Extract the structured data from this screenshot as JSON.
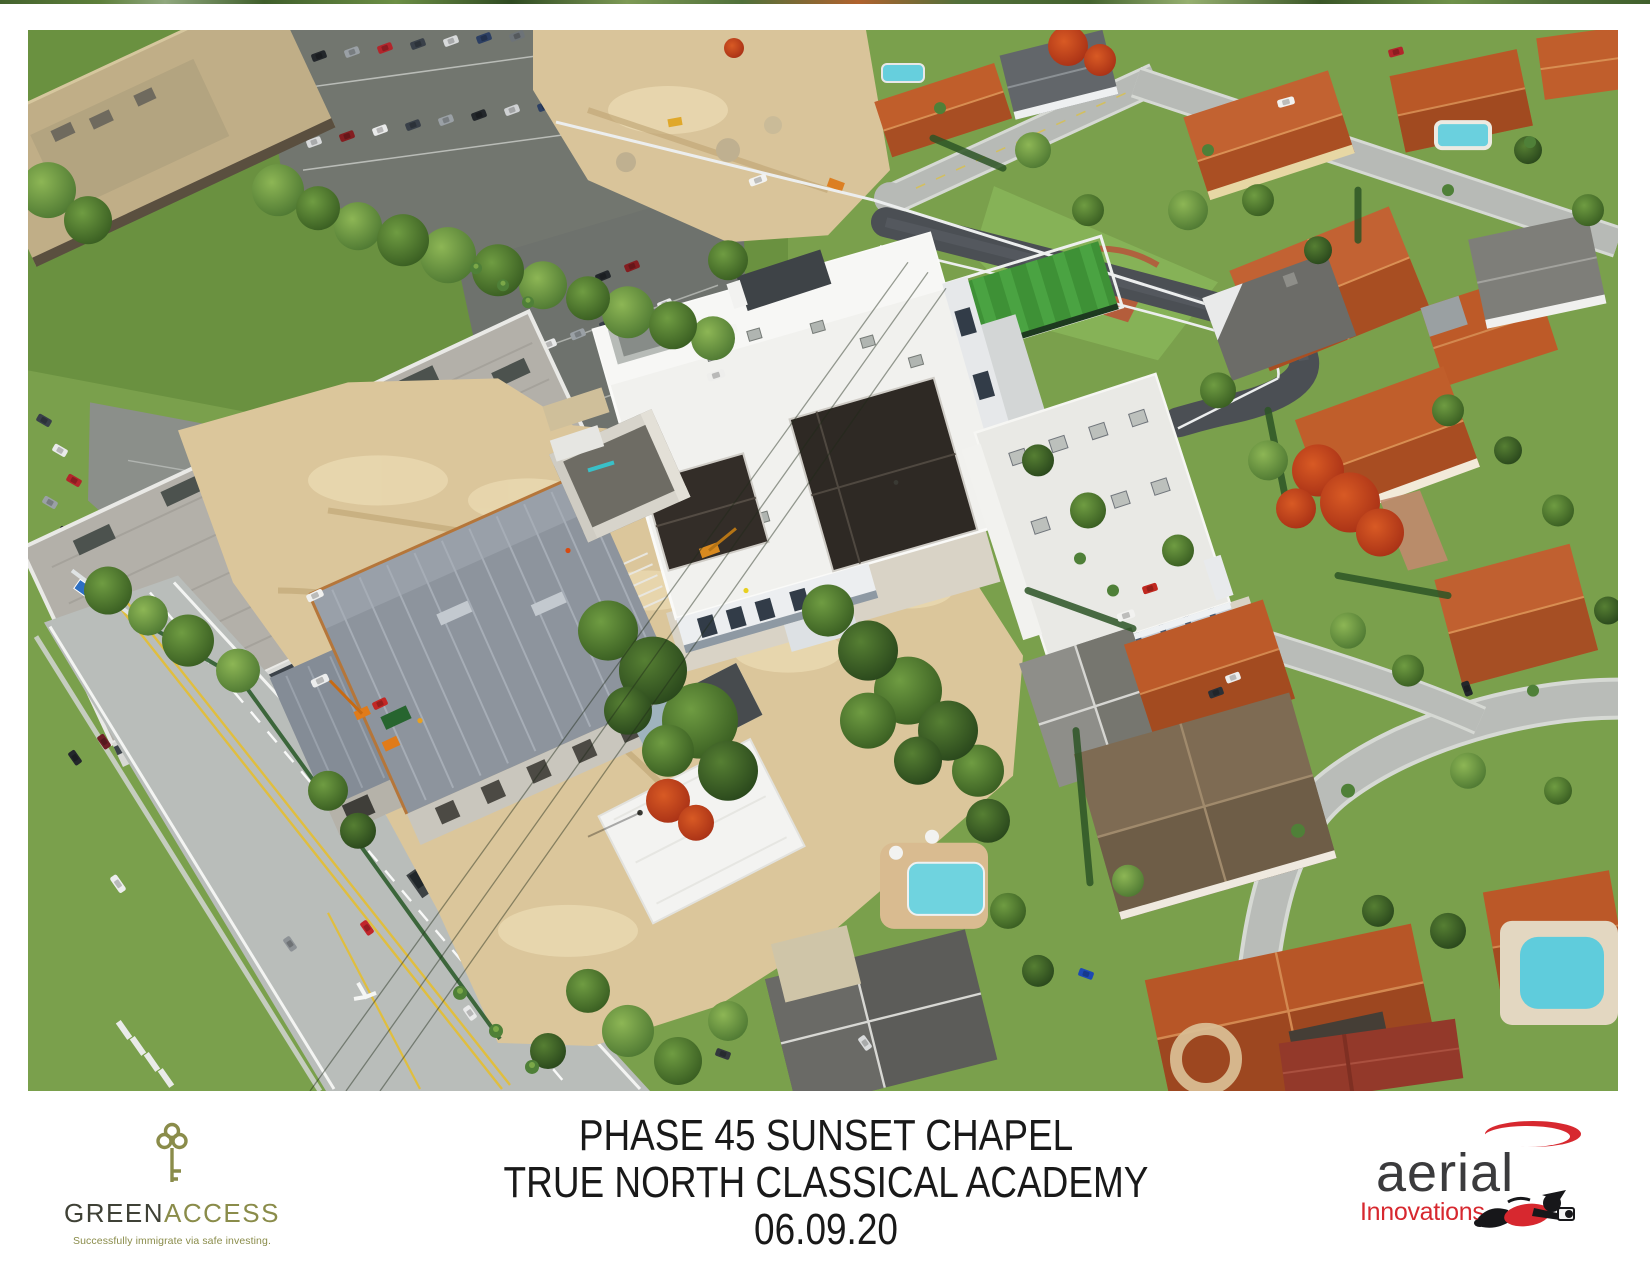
{
  "caption": {
    "line1": "PHASE 45 SUNSET CHAPEL",
    "line2": "TRUE NORTH CLASSICAL ACADEMY",
    "line3": "06.09.20",
    "text_color": "#191919"
  },
  "green_access": {
    "brand_part1": "GREEN",
    "brand_part2": "ACCESS",
    "tagline": "Successfully immigrate via safe investing.",
    "olive_color": "#8a8c4a",
    "charcoal_color": "#3f4136",
    "icon": "key-icon"
  },
  "aerial_innovations": {
    "brand": "aerial",
    "sub_brand": "Innovations",
    "red_color": "#d7282f",
    "gray_color": "#3b3b3d",
    "icons": [
      "swoosh-icon",
      "flying-photographer-icon"
    ]
  },
  "photo": {
    "description": "Oblique aerial photograph of the Phase 45 Sunset Chapel construction at True North Classical Academy: a gray concrete chapel shell on sandy ground, white academy buildings with dark pitched roofs, artificial turf field behind white fencing, a large gray office building with parking lots to the northwest, a multi-lane road along the southwest edge, and a residential neighborhood of orange- and gray-roofed homes with pools and palms to the east.",
    "palette": {
      "sand_dirt": "#dbc69b",
      "turf_green": "#3e9136",
      "lawn_green": "#7aa04c",
      "roof_orange": "#c05e2b",
      "pool_blue": "#66cfdd",
      "road_gray": "#b9bdba",
      "new_asphalt": "#4b4f54",
      "white_building": "#f1f1ee"
    }
  }
}
